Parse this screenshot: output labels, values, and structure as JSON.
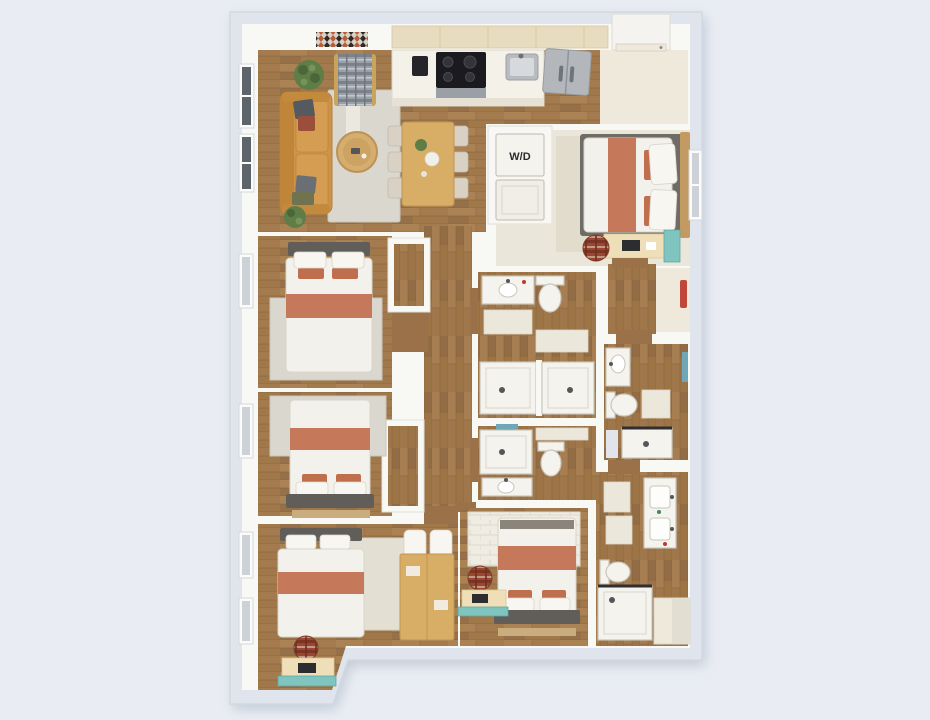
{
  "scene": {
    "type": "3D apartment floor plan rendering, top-down view",
    "rooms_visible": "open living-kitchen-dining, five bedrooms, four bathrooms, washer-dryer closet, entry, hallways"
  },
  "labels": {
    "washer_dryer": "W/D"
  },
  "palette": {
    "background": "#e9edf3",
    "outer_wall_band": "#e0e4ec",
    "wall": "#f8f8f5",
    "wood_floor": "#a07849",
    "carpet_bedroom1": "#ebe6da",
    "entry_floor": "#efe9dc",
    "sofa_leather": "#cd9348",
    "bedding_terracotta": "#c5795a",
    "accent_teal": "#7fc4bf",
    "towel_teal": "#6fa7b8",
    "wall_art_red": "#c0483a",
    "appliance_black": "#1b1b1f",
    "fixture_white": "#f4f3ee",
    "headboard_gray": "#615e5a"
  }
}
